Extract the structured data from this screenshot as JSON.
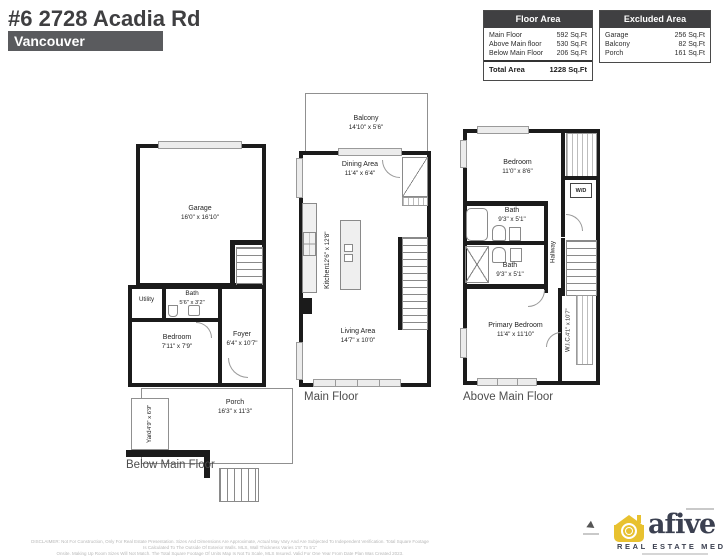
{
  "header": {
    "title": "#6 2728 Acadia Rd",
    "city": "Vancouver"
  },
  "tables": {
    "floor_area": {
      "title": "Floor Area",
      "rows": [
        {
          "label": "Main Floor",
          "value": "592 Sq.Ft"
        },
        {
          "label": "Above Main floor",
          "value": "530 Sq.Ft"
        },
        {
          "label": "Below Main Floor",
          "value": "206 Sq.Ft"
        }
      ],
      "total": {
        "label": "Total Area",
        "value": "1228 Sq.Ft"
      }
    },
    "excluded_area": {
      "title": "Excluded Area",
      "rows": [
        {
          "label": "Garage",
          "value": "256 Sq.Ft"
        },
        {
          "label": "Balcony",
          "value": "82 Sq.Ft"
        },
        {
          "label": "Porch",
          "value": "161 Sq.Ft"
        }
      ]
    }
  },
  "plans": {
    "below": {
      "label": "Below Main Floor",
      "rooms": {
        "garage": {
          "name": "Garage",
          "dims": "16'0\" x 16'10\""
        },
        "utility": {
          "name": "Utility"
        },
        "bath": {
          "name": "Bath",
          "dims": "5'6\" x 3'2\""
        },
        "bedroom": {
          "name": "Bedroom",
          "dims": "7'11\" x 7'9\""
        },
        "foyer": {
          "name": "Foyer",
          "dims": "6'4\" x 10'7\""
        },
        "porch": {
          "name": "Porch",
          "dims": "16'3\" x 11'3\""
        },
        "yard": {
          "name": "Yard",
          "dims": "4'9\" x 6'9\""
        }
      }
    },
    "main": {
      "label": "Main Floor",
      "rooms": {
        "balcony": {
          "name": "Balcony",
          "dims": "14'10\" x 5'6\""
        },
        "dining": {
          "name": "Dining Area",
          "dims": "11'4\" x 6'4\""
        },
        "kitchen": {
          "name": "Kitchen",
          "dims": "12'6\" x 12'8\""
        },
        "living": {
          "name": "Living Area",
          "dims": "14'7\" x 10'0\""
        }
      }
    },
    "above": {
      "label": "Above Main Floor",
      "rooms": {
        "bedroom": {
          "name": "Bedroom",
          "dims": "11'0\" x 8'6\""
        },
        "wd": {
          "name": "W/D"
        },
        "bath_upper": {
          "name": "Bath",
          "dims": "9'3\" x 5'1\""
        },
        "bath_lower": {
          "name": "Bath",
          "dims": "9'3\" x 5'1\""
        },
        "hallway": {
          "name": "Hallway"
        },
        "primary": {
          "name": "Primary Bedroom",
          "dims": "11'4\" x 11'10\""
        },
        "wic": {
          "name": "W.I.C.",
          "dims": "4'1\" x 10'7\""
        }
      }
    }
  },
  "footer": {
    "disclaimer_line1": "DISCLAIMER: Not For Construction, Only For Real Estate Presentation. Sizes And Dimensions Are Approximate, Actual May Vary And Are Subjected To Independent Verification. Total Square Footage Is Calculated To The Outside Of Exterior Walls. MLS, Wall Thickness Varies 1'5\" To 5'1\"",
    "disclaimer_line2": "Onsite. Making Up Room Sizes Will Not Match. The Total Square Footage Of Units Map Is Not To Scale, MLS Insured. Valid For One Year From Date Plan Was Created 2023.",
    "logo": {
      "brand": "afive",
      "subtitle": "REAL ESTATE MEDIA"
    }
  }
}
